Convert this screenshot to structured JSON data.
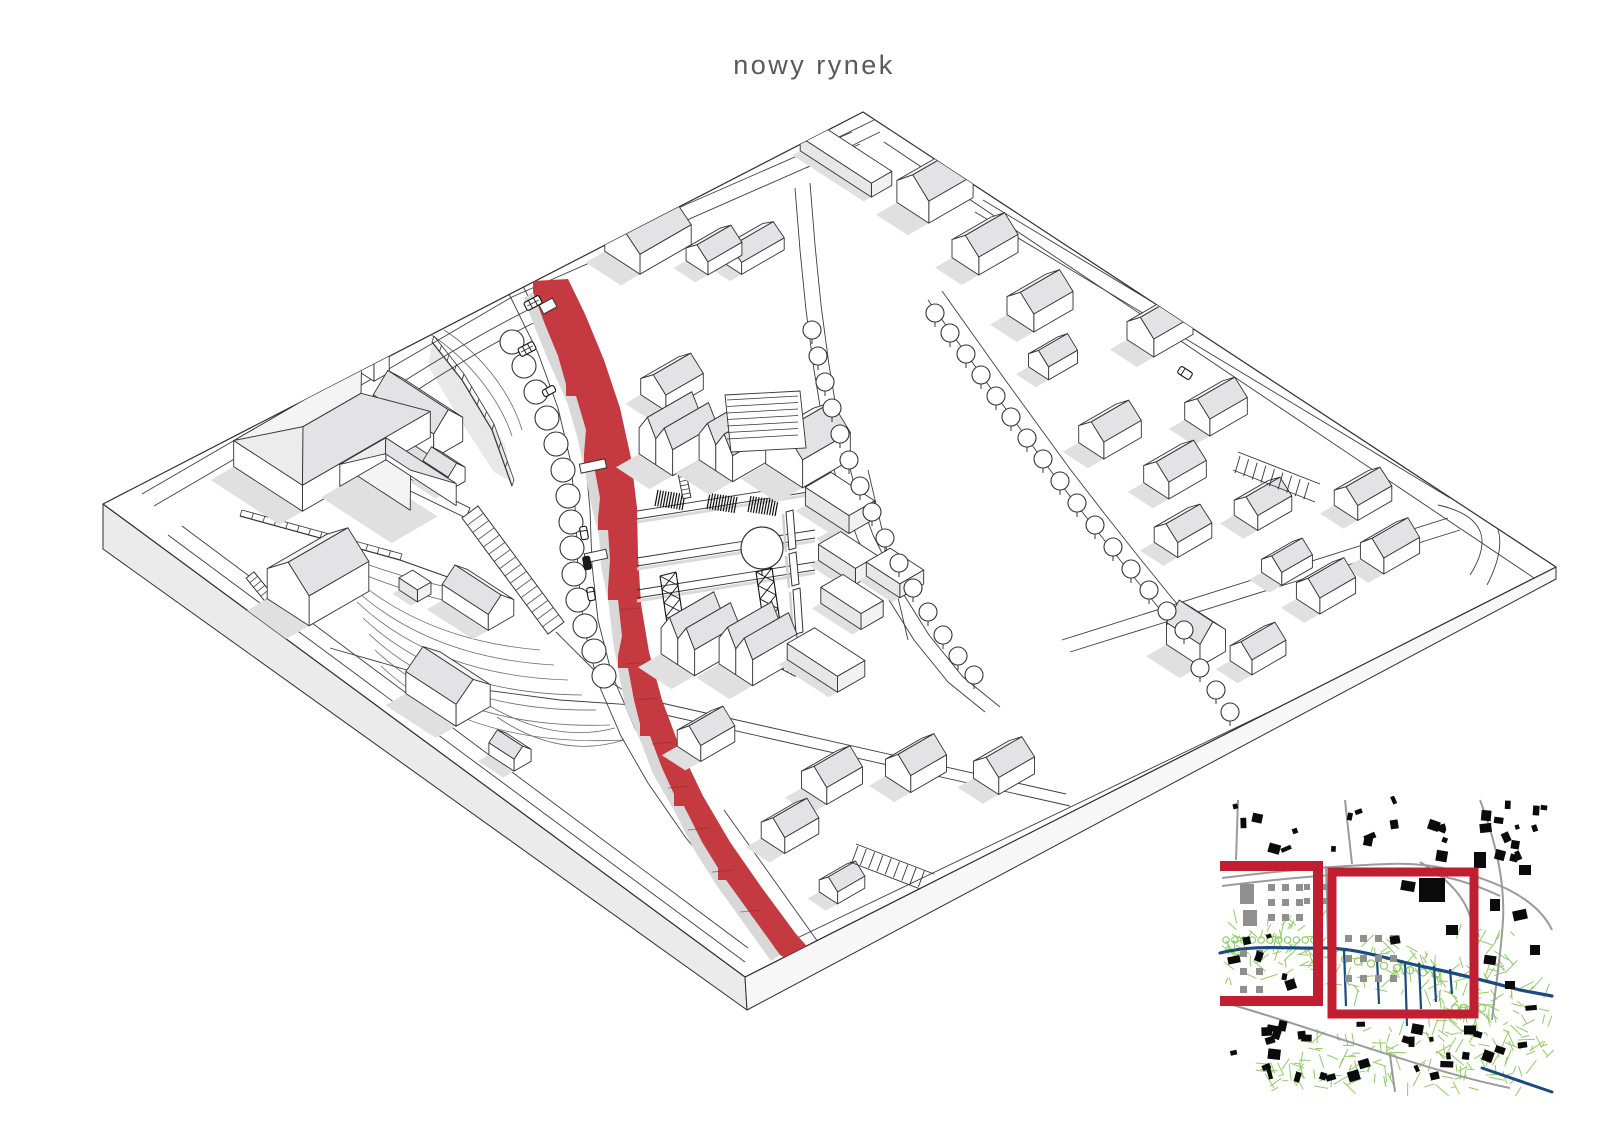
{
  "title": {
    "text": "nowy rynek",
    "color": "#58595c"
  },
  "scene": {
    "background": "#ffffff",
    "line_color": "#333333",
    "plate_edge_color": "#2e2e2e",
    "roof_gray": "#e3e3e5",
    "roof_light": "#f4f4f4",
    "wall_white": "#ffffff",
    "shadow_gray": "#e0e0e1",
    "plate_side_sw": "#ebebec",
    "plate_side_se": "#f7f7f7",
    "street_red": "#c43a40",
    "street_red_shadow": "#d8d8d9",
    "road_line": "#3c3c3c",
    "contour_line": "#6a6a6a"
  },
  "inset_map": {
    "background": "#ffffff",
    "building_black": "#0b0b0b",
    "estate_gray": "#8f8f8f",
    "road_gray": "#9b9b9b",
    "vegetation_green": "#8fcc63",
    "water_blue": "#1b4a7e",
    "highlight_red": "#c01f31"
  }
}
